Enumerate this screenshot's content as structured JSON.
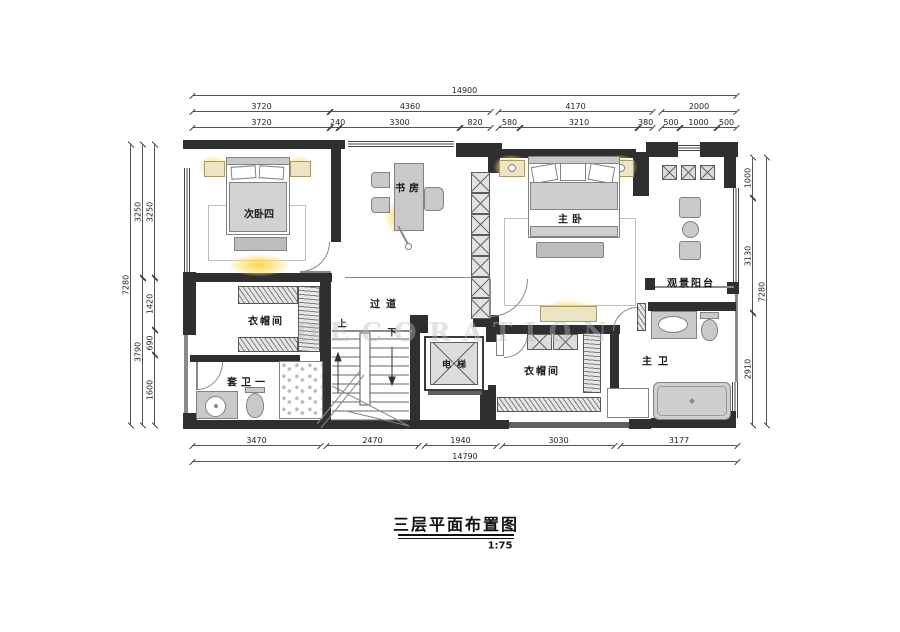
{
  "title": {
    "text": "三层平面布置图",
    "scale": "1:75"
  },
  "rooms": {
    "bedroom4": "次卧四",
    "study": "书房",
    "master_bedroom": "主卧",
    "balcony": "观景阳台",
    "cloakroom_west": "衣帽间",
    "corridor": "过道",
    "elevator": "电梯",
    "bath_one": "套卫一",
    "cloakroom_master": "衣帽间",
    "master_bath": "主卫",
    "stairs_up": "上",
    "stairs_down": "下"
  },
  "dimensions": {
    "top": {
      "total": "14900",
      "row2": [
        "3720",
        "4360",
        "4170",
        "2000"
      ],
      "row3": [
        "3720",
        "240",
        "3300",
        "820",
        "580",
        "3210",
        "380",
        "500",
        "1000",
        "500"
      ]
    },
    "bottom": {
      "total": "14790",
      "row": [
        "3470",
        "2470",
        "1940",
        "3030",
        "3177"
      ]
    },
    "left": {
      "total": "7280",
      "mid": [
        "3250",
        "3790"
      ],
      "inner": [
        "3250",
        "1420",
        "690",
        "1600"
      ]
    },
    "right": {
      "total": "7280",
      "inner": [
        "1000",
        "3130",
        "2910"
      ]
    }
  },
  "watermark": "DECORATION",
  "colors": {
    "wall": "#2f2f2f",
    "furniture": "#c9c9c9",
    "wood": "#ece4c2",
    "glow": "#ffd54f"
  }
}
